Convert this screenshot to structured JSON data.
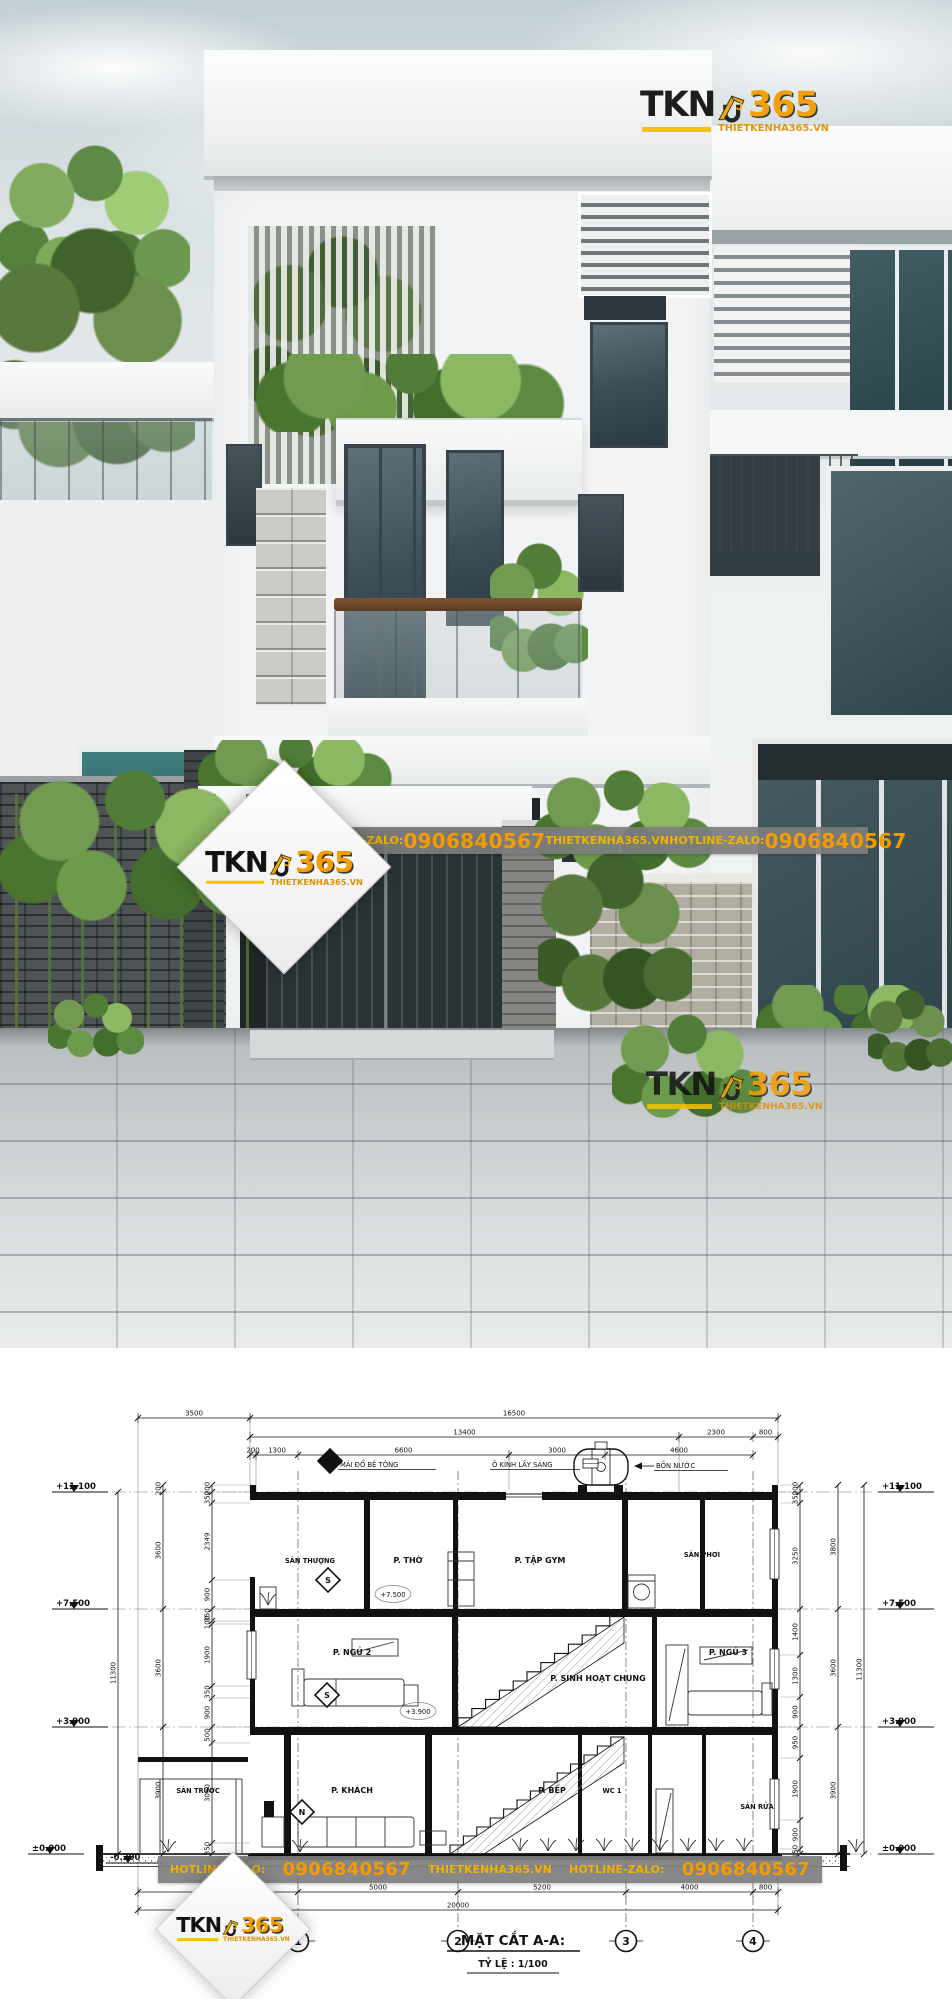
{
  "brand": {
    "tkn": "TKN",
    "num": "365",
    "domain": "THIETKENHA365.VN"
  },
  "strip": {
    "hotline": "HOTLINE-ZALO:",
    "phone": "0906840567",
    "domain": "THIETKENHA365.VN"
  },
  "colors": {
    "accent_orange": "#F59D00",
    "logo_underline_yellow": "#F6C100",
    "strip_gray": "#8A8A8A",
    "drawing_line": "#111111"
  },
  "section": {
    "title": "MẶT CẮT A-A:",
    "scale": "TỶ LỆ : 1/100",
    "grid": [
      "1",
      "2",
      "3",
      "4"
    ],
    "rooms_f3": [
      "SÂN THƯỢNG",
      "P. THỜ",
      "P. TẬP GYM",
      "SÂN PHƠI"
    ],
    "rooms_f2": [
      "P. NGỦ 2",
      "P. SINH HOẠT CHUNG",
      "P. NGỦ 3"
    ],
    "rooms_g": [
      "SÂN TRƯỚC",
      "P. KHÁCH",
      "P. BẾP",
      "WC 1",
      "SÂN RỬA"
    ],
    "annotations": [
      "MÁI ĐỔ BÊ TÔNG",
      "Ô KÍNH LẤY SÁNG",
      "BỒN NƯỚC"
    ],
    "plan_levels": [
      "+7.500",
      "+3.900"
    ],
    "markers": [
      "M",
      "S",
      "S",
      "N"
    ],
    "levels_left": [
      "+11.100",
      "+7.500",
      "+3.900",
      "±0.000",
      "-0.200"
    ],
    "levels_right": [
      "+11.100",
      "+7.500",
      "+3.900",
      "±0.000"
    ],
    "dims_top1": [
      "3500",
      "16500"
    ],
    "dims_top2": [
      "13400",
      "2300",
      "800"
    ],
    "dims_top3": [
      "200",
      "1300",
      "6600",
      "3000",
      "4600"
    ],
    "dims_bottom": [
      "5000",
      "5000",
      "5200",
      "4000",
      "800"
    ],
    "dims_bottom_total": [
      "20000"
    ],
    "dims_left_outer": [
      "11300"
    ],
    "dims_left_mid": [
      "200",
      "3600",
      "3600",
      "3900"
    ],
    "dims_left_inner": [
      "200",
      "350",
      "2349",
      "900",
      "350",
      "100",
      "1900",
      "350",
      "900",
      "500",
      "3050",
      "350"
    ],
    "dims_right_outer": [
      "11300"
    ],
    "dims_right_mid": [
      "3800",
      "3600",
      "3900"
    ],
    "dims_right_inner": [
      "200",
      "350",
      "3250",
      "1400",
      "1300",
      "900",
      "950",
      "1900",
      "900",
      "150"
    ]
  }
}
